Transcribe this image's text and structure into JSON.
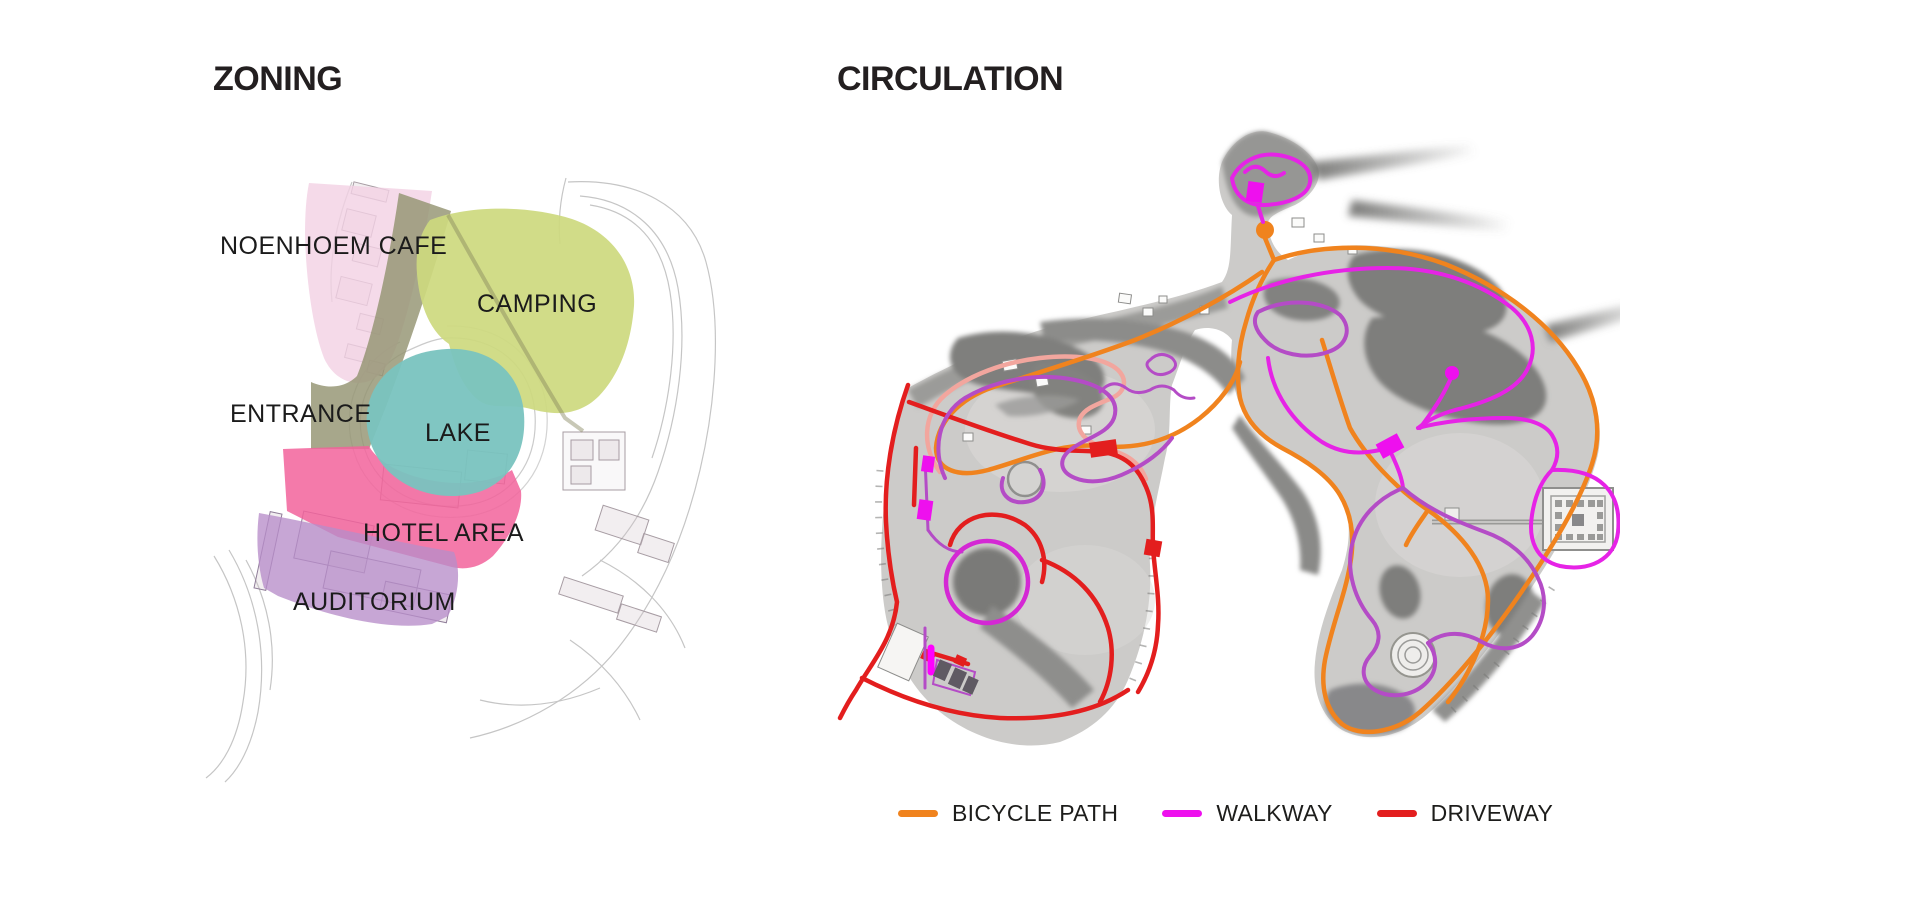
{
  "zoning": {
    "title": "ZONING",
    "labels": {
      "cafe": "NOENHOEM CAFE",
      "camping": "CAMPING",
      "entrance": "ENTRANCE",
      "lake": "LAKE",
      "hotel": "HOTEL AREA",
      "auditorium": "AUDITORIUM"
    },
    "zone_colors": {
      "cafe": "#F3D1E3",
      "camping": "#CDD97E",
      "entrance": "#949472",
      "lake": "#79C3BF",
      "hotel": "#F2639B",
      "auditorium": "#B78DC9"
    }
  },
  "circulation": {
    "title": "CIRCULATION",
    "legend": [
      {
        "label": "BICYCLE PATH",
        "color": "#F0831E"
      },
      {
        "label": "WALKWAY",
        "color": "#EE10EE"
      },
      {
        "label": "DRIVEWAY",
        "color": "#E31E1E"
      }
    ],
    "path_colors": {
      "bicycle": "#F0831E",
      "walkway_bright": "#E623E6",
      "walkway_purple": "#B44CC6",
      "driveway": "#E31E1E",
      "pedestrian_pink": "#F2A69E"
    }
  }
}
